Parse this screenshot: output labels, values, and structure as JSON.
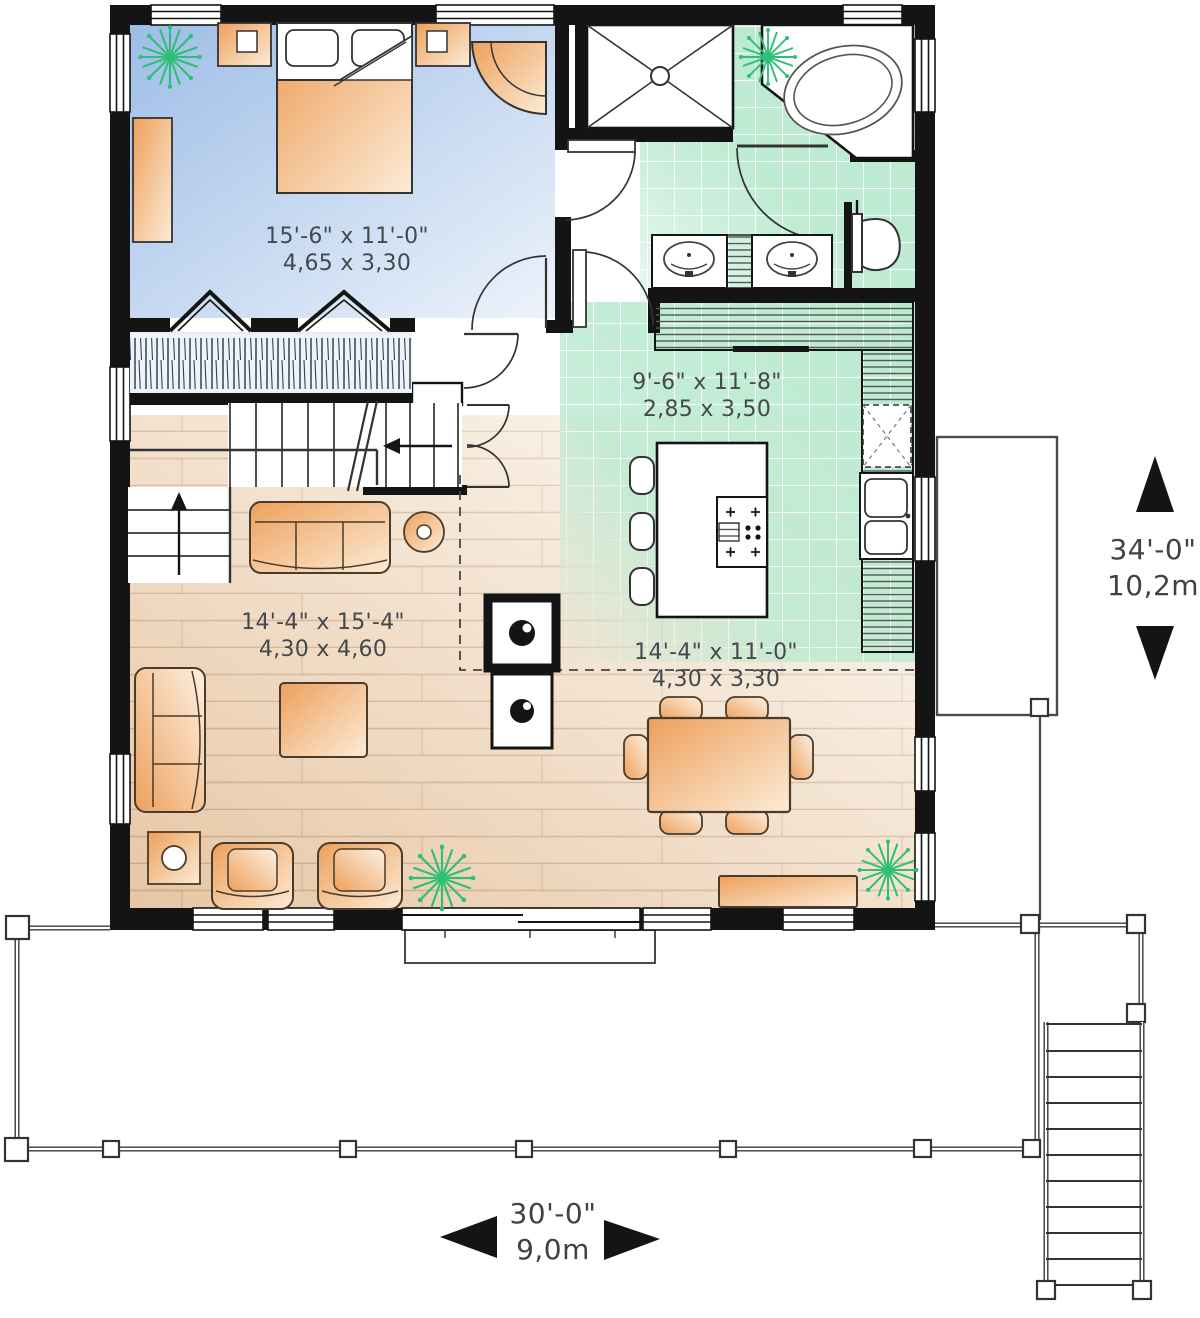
{
  "plan": {
    "type": "floor-plan",
    "units": "imperial-and-metric",
    "rooms": [
      {
        "id": "bedroom",
        "dim_imperial": "15'-6\" x 11'-0\"",
        "dim_metric": "4,65 x 3,30"
      },
      {
        "id": "kitchen",
        "dim_imperial": "9'-6\" x 11'-8\"",
        "dim_metric": "2,85 x 3,50"
      },
      {
        "id": "living-room",
        "dim_imperial": "14'-4\" x 15'-4\"",
        "dim_metric": "4,30 x 4,60"
      },
      {
        "id": "dining-room",
        "dim_imperial": "14'-4\" x 11'-0\"",
        "dim_metric": "4,30 x 3,30"
      }
    ]
  },
  "labels": {
    "bedroom": {
      "imperial": "15'-6\" x 11'-0\"",
      "metric": "4,65 x 3,30"
    },
    "kitchen": {
      "imperial": "9'-6\" x 11'-8\"",
      "metric": "2,85 x 3,50"
    },
    "living": {
      "imperial": "14'-4\" x 15'-4\"",
      "metric": "4,30 x 4,60"
    },
    "dining": {
      "imperial": "14'-4\" x 11'-0\"",
      "metric": "4,30 x 3,30"
    }
  },
  "dimensions": {
    "overall_depth": {
      "imperial": "34'-0\"",
      "metric": "10,2m"
    },
    "overall_width": {
      "imperial": "30'-0\"",
      "metric": "9,0m"
    }
  },
  "fixtures": [
    "bed",
    "nightstand",
    "dresser",
    "corner-chair",
    "closet",
    "staircase",
    "shower",
    "corner-bathtub",
    "double-vanity",
    "toilet",
    "kitchen-counter",
    "kitchen-island",
    "bar-stool",
    "double-sink",
    "refrigerator",
    "sofa",
    "loveseat",
    "armchair",
    "coffee-table",
    "lamp-table",
    "wood-stove",
    "dining-table",
    "dining-chair",
    "sideboard",
    "plant",
    "deck",
    "deck-stairs"
  ],
  "colors": {
    "wall": "#141414",
    "bedroom_floor": "#a9c6e9",
    "tile_floor": "#b9e9cf",
    "wood_floor": "#e8cbad",
    "furniture": "#eda express05c",
    "furniture_light": "#fce8d2",
    "plant": "#2fbf76",
    "text": "#44494d"
  }
}
